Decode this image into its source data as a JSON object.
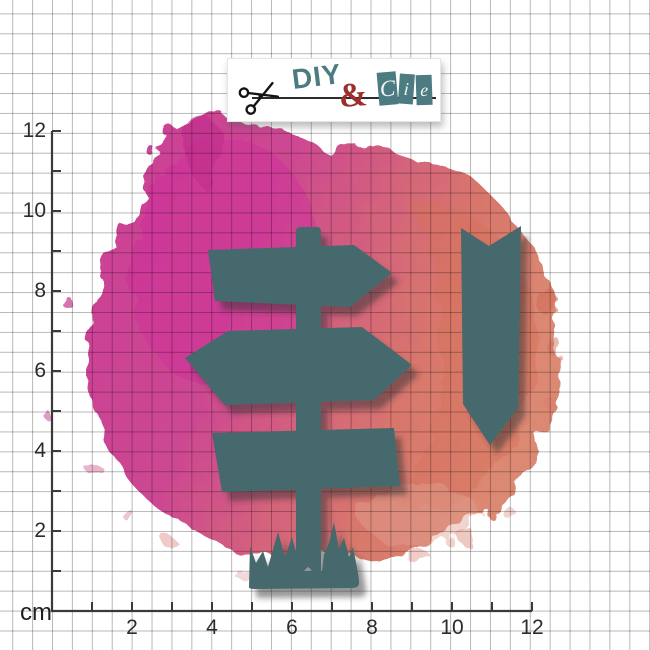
{
  "brand": {
    "name_part1": "DIY",
    "ampersand": "&",
    "cie_letters": [
      "C",
      "i",
      "e"
    ]
  },
  "ruler": {
    "unit": "cm",
    "x_axis_labels": [
      "2",
      "4",
      "6",
      "8",
      "10",
      "12"
    ],
    "y_axis_labels": [
      "2",
      "4",
      "6",
      "8",
      "10",
      "12"
    ],
    "tick_count": 12,
    "label_step": 2
  },
  "shapes": {
    "fill_color": "#44696c",
    "items": [
      "signpost-post-with-grass",
      "top-arrow-sign-panel",
      "middle-double-point-sign-panel",
      "bottom-rectangle-sign-panel",
      "chevron-banner-marker"
    ]
  },
  "splash_colors": {
    "magenta": "#c7308f",
    "bright_pink": "#cf2f9b",
    "deep_pink": "#c02a8c",
    "coral": "#d4705a",
    "light_coral": "#e0a091"
  },
  "ui_colors": {
    "axis": "#3a3a3a",
    "label_text": "#2b2b2b",
    "logo_teal": "#4c7b82",
    "logo_red": "#9d2e2e",
    "shadow": "#2f2f2f"
  }
}
